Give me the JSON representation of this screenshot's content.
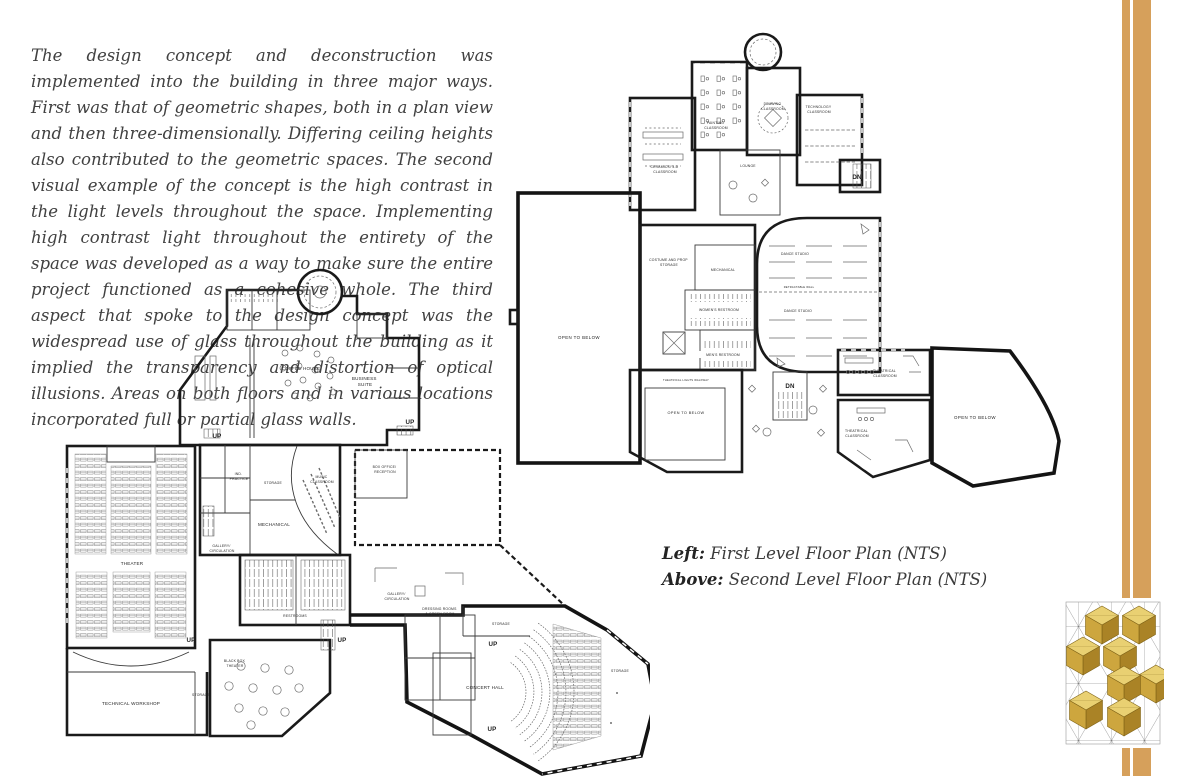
{
  "page": {
    "background": "#ffffff",
    "accent_gold": "#d6a05b",
    "wall_color": "#1a1a1a"
  },
  "intro": {
    "text": "The design concept and deconstruction was implemented into the building in three major ways. First was that of geometric shapes, both in a plan view and then three-dimensionally. Differing ceiling heights also contributed to the geometric spaces. The second visual example of the concept is the high contrast in the light levels throughout the space. Implementing high contrast light throughout the entirety of the space was developed as a way to make sure the entire project functioned as a cohesive whole. The third aspect that spoke to the design concept was the widespread use of glass throughout the building as it implied the transparency and distortion of optical illusions. Areas on both floors and in various locations incorporated full or partial glass walls."
  },
  "captions": {
    "left_bold": "Left:",
    "left_rest": " First Level Floor Plan (NTS)",
    "above_bold": "Above:",
    "above_rest": " Second Level Floor Plan (NTS)"
  },
  "first_floor": {
    "title": "First Level Floor Plan",
    "labels": {
      "theater": "THEATER",
      "technical_workshop": "TECHNICAL WORKSHOP",
      "black_box_1": "BLACK BOX",
      "black_box_2": "THEATER",
      "storage_a": "STORAGE",
      "restrooms": "RESTROOMS",
      "coffee_house": "COFFEE HOUSE",
      "business_suite_1": "BUSINESS",
      "business_suite_2": "SUITE",
      "ind_practice_1": "IND.",
      "ind_practice_2": "PRACTICE",
      "storage_b": "STORAGE",
      "music_1": "MUSIC",
      "music_2": "CLASSROOM",
      "mechanical": "MECHANICAL",
      "box_office_1": "BOX OFFICE/",
      "box_office_2": "RECEPTION",
      "gallery_1a": "GALLERY/",
      "gallery_1b": "CIRCULATION",
      "gallery_2a": "GALLERY/",
      "gallery_2b": "CIRCULATION",
      "dressing_1": "DRESSING ROOMS",
      "dressing_2": "& GREEN ROOM",
      "storage_c": "STORAGE",
      "concert_hall": "CONCERT HALL",
      "storage_d": "STORAGE",
      "up": "UP"
    }
  },
  "second_floor": {
    "title": "Second Level Floor Plan",
    "labels": {
      "painting_1": "PAINTING",
      "painting_2": "CLASSROOM",
      "drawing_1": "DRAWING",
      "drawing_2": "CLASSROOM",
      "technology_1": "TECHNOLOGY",
      "technology_2": "CLASSROOM",
      "ceramics_1": "CERAMICS/ 3-D",
      "ceramics_2": "CLASSROOM",
      "lounge": "LOUNGE",
      "costume_1": "COSTUME AND PROP",
      "costume_2": "STORAGE",
      "mechanical": "MECHANICAL",
      "womens_restroom": "WOMEN'S RESTROOM",
      "mens_restroom": "MEN'S RESTROOM",
      "dance_studio_a": "DANCE STUDIO",
      "dance_studio_b": "DANCE STUDIO",
      "retractable_wall": "RETRACTABLE WALL",
      "open_to_below_left": "OPEN TO BELOW",
      "open_to_below_small": "OPEN TO BELOW",
      "open_to_below_right": "OPEN TO BELOW",
      "theatrical_lights_walkway": "THEATRICAL LIGHTS WALKWAY",
      "theatrical_1a": "THEATRICAL",
      "theatrical_1b": "CLASSROOM",
      "theatrical_2a": "THEATRICAL",
      "theatrical_2b": "CLASSROOM",
      "dn": "DN"
    }
  }
}
